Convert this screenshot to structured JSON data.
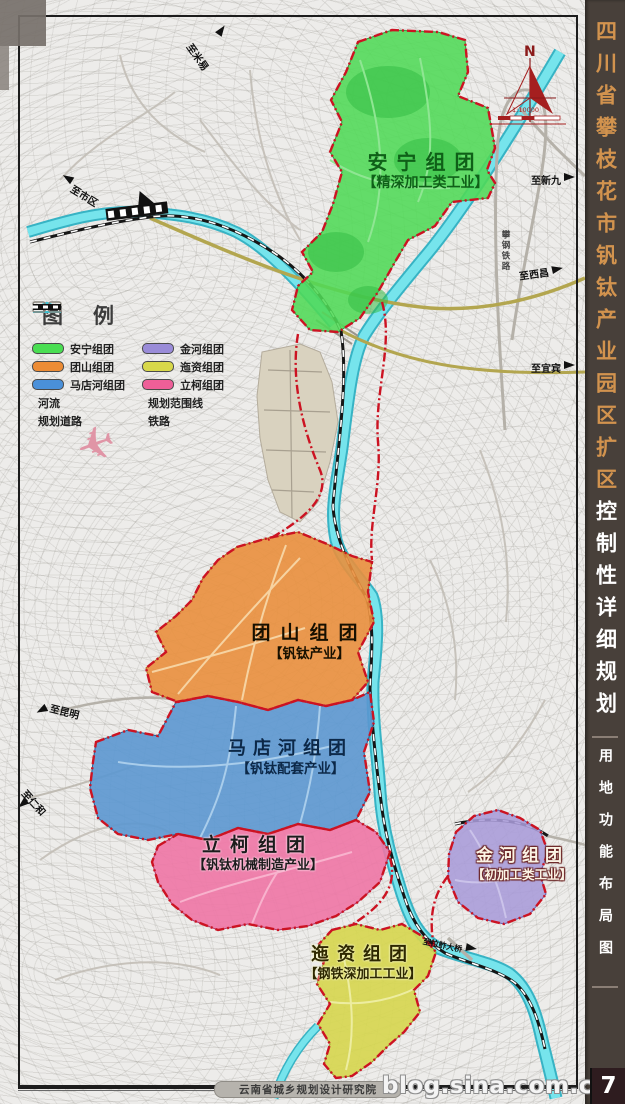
{
  "title_strip": {
    "region_line": "四川省攀枝花市钒钛产业园区扩区",
    "plan_line": "控制性详细规划",
    "map_type": "用地功能布局图",
    "bg_color": "#48403a",
    "region_color": "#d2934e",
    "plan_color": "#ffffff"
  },
  "legend": {
    "title": "图例",
    "items": [
      {
        "label": "安宁组团",
        "color": "#4ade52",
        "type": "swatch"
      },
      {
        "label": "团山组团",
        "color": "#ec8c35",
        "type": "swatch"
      },
      {
        "label": "马店河组团",
        "color": "#4a90d9",
        "type": "swatch"
      },
      {
        "label": "河流",
        "type": "river"
      },
      {
        "label": "规划道路",
        "type": "road"
      },
      {
        "label": "金河组团",
        "color": "#9a8cd8",
        "type": "swatch"
      },
      {
        "label": "迤资组团",
        "color": "#d8d84a",
        "type": "swatch"
      },
      {
        "label": "立柯组团",
        "color": "#ee5f98",
        "type": "swatch"
      },
      {
        "label": "规划范围线",
        "type": "boundary"
      },
      {
        "label": "铁路",
        "type": "railway"
      }
    ]
  },
  "zones": [
    {
      "name": "安宁组团",
      "industry": "【精深加工类工业】",
      "color": "#50d957"
    },
    {
      "name": "团山组团",
      "industry": "【钒钛产业】",
      "color": "#e98f3d"
    },
    {
      "name": "马店河组团",
      "industry": "【钒钛配套产业】",
      "color": "#5b97d0"
    },
    {
      "name": "立柯组团",
      "industry": "【钒钛机械制造产业】",
      "color": "#ee76a5"
    },
    {
      "name": "金河组团",
      "industry": "【初加工类工业】",
      "color": "#a99bd8"
    },
    {
      "name": "迤资组团",
      "industry": "【钢铁深加工工业】",
      "color": "#d6d64e"
    }
  ],
  "map_labels": {
    "to_miyi": "至米易",
    "to_xinjiu": "至新九",
    "to_xichang": "至西昌",
    "to_yibin": "至宜宾",
    "to_city": "至市区",
    "to_kunming": "至昆明",
    "to_renhe": "至仁和",
    "lazha_bridge": "至拉鲊大桥",
    "railway_name": "攀钢铁路"
  },
  "compass": {
    "north_label": "N",
    "scale_text": "1:10000"
  },
  "footer": {
    "institute": "云南省城乡规划设计研究院",
    "watermark": "blog.sina.com.cn/xiagrui",
    "logo_text": "7"
  }
}
